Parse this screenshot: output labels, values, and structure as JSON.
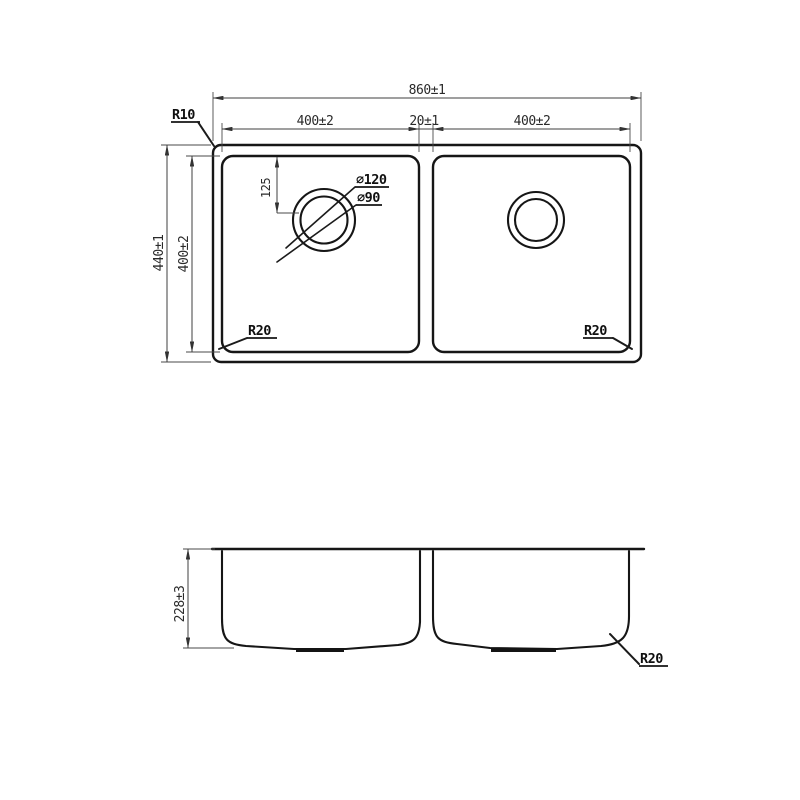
{
  "drawing": {
    "background": "#ffffff",
    "line_color": "#1a1a1a",
    "subject": "double-bowl-sink-technical-drawing",
    "views": {
      "top_view": {
        "overall_width": "860±1",
        "left_bowl_width": "400±2",
        "divider_width": "20±1",
        "right_bowl_width": "400±2",
        "overall_depth": "440±1",
        "bowl_depth": "400±2",
        "drain_offset": "125",
        "rim_corner_radius": "R10",
        "left_bowl_corner_radius": "R20",
        "right_bowl_corner_radius": "R20",
        "drain_outer_diameter": "∅120",
        "drain_inner_diameter": "∅90"
      },
      "section_view": {
        "bowl_depth": "228±3",
        "bottom_corner_radius": "R20"
      }
    }
  }
}
